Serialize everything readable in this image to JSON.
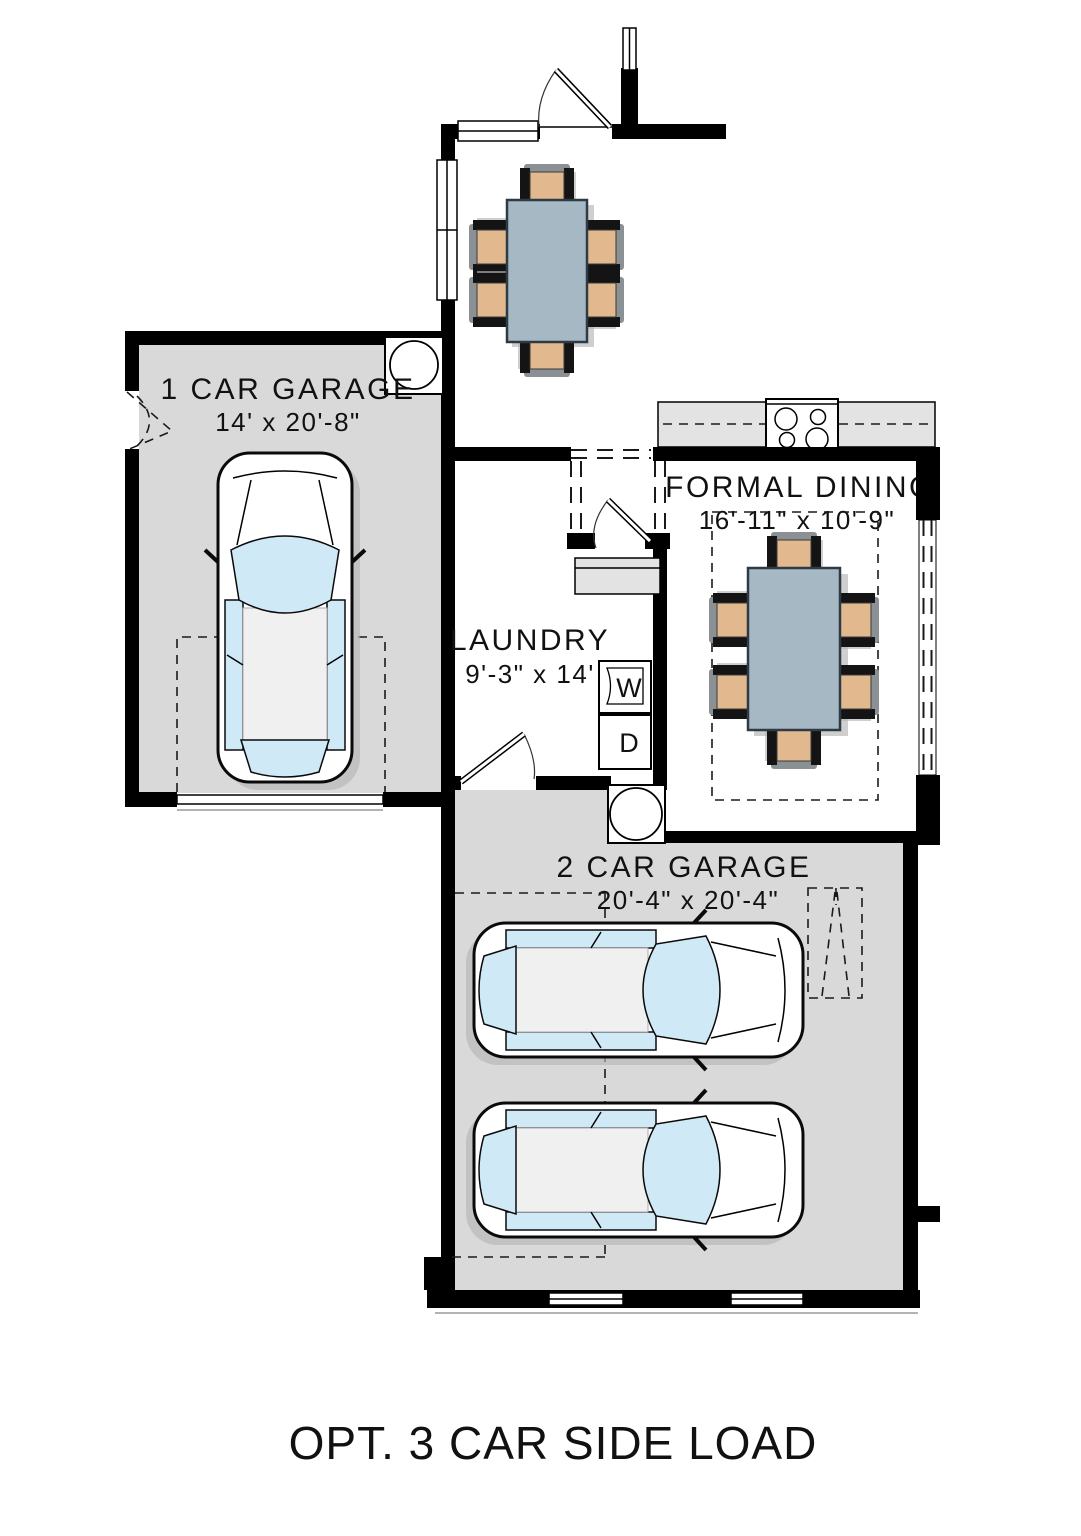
{
  "floor_plan": {
    "caption": "OPT. 3 CAR SIDE LOAD",
    "rooms": [
      {
        "id": "garage-1",
        "name": "1 CAR GARAGE",
        "dims": "14' x 20'-8\""
      },
      {
        "id": "formal-dining",
        "name": "FORMAL DINING",
        "dims": "16'-11\" x 10'-9\""
      },
      {
        "id": "laundry",
        "name": "LAUNDRY",
        "dims": "9'-3\" x 14'"
      },
      {
        "id": "garage-2",
        "name": "2 CAR GARAGE",
        "dims": "20'-4\" x 20'-4\""
      }
    ],
    "appliances": {
      "washer_label": "W",
      "dryer_label": "D"
    },
    "colors": {
      "wall": "#000000",
      "garage_floor": "#d9d9d9",
      "counter": "#e3e3e3",
      "table_top": "#a5b8c4",
      "chair_seat": "#e2b98e",
      "car_glass": "#cfe9f7",
      "shadow": "#b5b5b5",
      "background": "#ffffff"
    }
  }
}
